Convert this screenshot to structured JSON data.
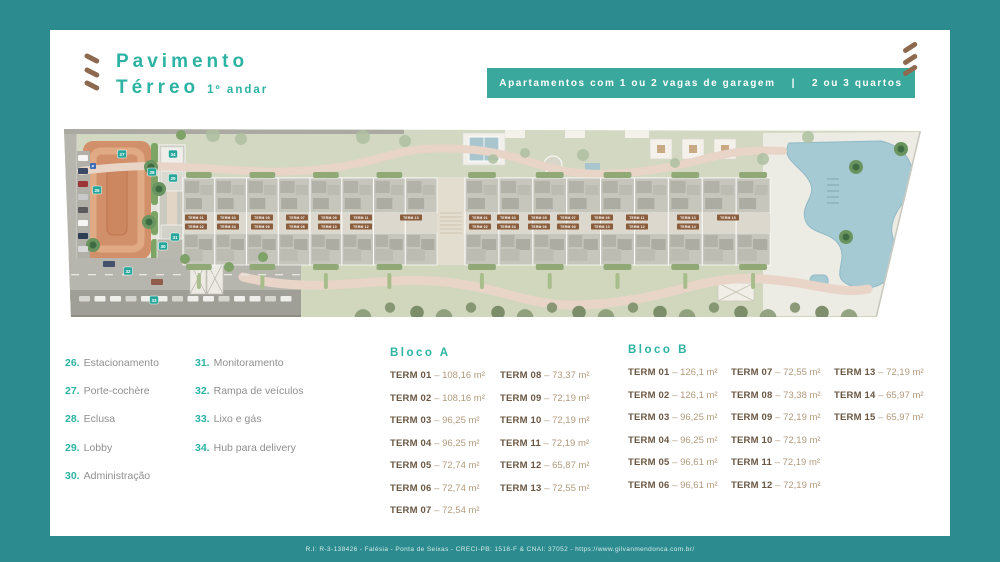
{
  "header": {
    "title_line1": "Pavimento",
    "title_line2": "Térreo",
    "title_suffix": "1º andar",
    "banner_left": "Apartamentos com 1 ou 2 vagas de garagem",
    "banner_divider": "|",
    "banner_right": "2 ou 3 quartos"
  },
  "legend": {
    "column1": [
      {
        "num": "26.",
        "label": "Estacionamento"
      },
      {
        "num": "27.",
        "label": "Porte-cochère"
      },
      {
        "num": "28.",
        "label": "Eclusa"
      },
      {
        "num": "29.",
        "label": "Lobby"
      },
      {
        "num": "30.",
        "label": "Administração"
      }
    ],
    "column2": [
      {
        "num": "31.",
        "label": "Monitoramento"
      },
      {
        "num": "32.",
        "label": "Rampa de veículos"
      },
      {
        "num": "33.",
        "label": "Lixo e gás"
      },
      {
        "num": "34.",
        "label": "Hub para delivery"
      }
    ]
  },
  "separator": "–",
  "bloco_a": {
    "title": "Bloco A",
    "columns": [
      [
        {
          "term": "TERM 01",
          "area": "108,16 m²"
        },
        {
          "term": "TERM 02",
          "area": "108,16 m²"
        },
        {
          "term": "TERM 03",
          "area": "96,25 m²"
        },
        {
          "term": "TERM 04",
          "area": "96,25 m²"
        },
        {
          "term": "TERM 05",
          "area": "72,74 m²"
        },
        {
          "term": "TERM 06",
          "area": "72,74 m²"
        },
        {
          "term": "TERM 07",
          "area": "72,54 m²"
        }
      ],
      [
        {
          "term": "TERM 08",
          "area": "73,37 m²"
        },
        {
          "term": "TERM 09",
          "area": "72,19 m²"
        },
        {
          "term": "TERM 10",
          "area": "72,19 m²"
        },
        {
          "term": "TERM 11",
          "area": "72,19 m²"
        },
        {
          "term": "TERM 12",
          "area": "65,87 m²"
        },
        {
          "term": "TERM 13",
          "area": "72,55 m²"
        }
      ]
    ]
  },
  "bloco_b": {
    "title": "Bloco B",
    "columns": [
      [
        {
          "term": "TERM 01",
          "area": "126,1 m²"
        },
        {
          "term": "TERM 02",
          "area": "126,1 m²"
        },
        {
          "term": "TERM 03",
          "area": "96,25 m²"
        },
        {
          "term": "TERM 04",
          "area": "96,25 m²"
        },
        {
          "term": "TERM 05",
          "area": "96,61 m²"
        },
        {
          "term": "TERM 06",
          "area": "96,61 m²"
        }
      ],
      [
        {
          "term": "TERM 07",
          "area": "72,55 m²"
        },
        {
          "term": "TERM 08",
          "area": "73,38 m²"
        },
        {
          "term": "TERM 09",
          "area": "72,19 m²"
        },
        {
          "term": "TERM 10",
          "area": "72,19 m²"
        },
        {
          "term": "TERM 11",
          "area": "72,19 m²"
        },
        {
          "term": "TERM 12",
          "area": "72,19 m²"
        }
      ],
      [
        {
          "term": "TERM 13",
          "area": "72,19 m²"
        },
        {
          "term": "TERM 14",
          "area": "65,97 m²"
        },
        {
          "term": "TERM 15",
          "area": "65,97 m²"
        }
      ]
    ]
  },
  "plan": {
    "badges": [
      {
        "num": "27",
        "x": 59,
        "y": 27
      },
      {
        "num": "34",
        "x": 110,
        "y": 27
      },
      {
        "num": "28",
        "x": 89,
        "y": 45
      },
      {
        "num": "29",
        "x": 110,
        "y": 51
      },
      {
        "num": "26",
        "x": 34,
        "y": 63
      },
      {
        "num": "31",
        "x": 112,
        "y": 110
      },
      {
        "num": "30",
        "x": 100,
        "y": 119
      },
      {
        "num": "32",
        "x": 65,
        "y": 144
      },
      {
        "num": "33",
        "x": 91,
        "y": 173
      }
    ],
    "parking_symbol": "P",
    "unit_labels_a": [
      "TERM 01",
      "TERM 02",
      "TERM 03",
      "TERM 04",
      "TERM 05",
      "TERM 06",
      "TERM 07",
      "TERM 08",
      "TERM 09",
      "TERM 10",
      "TERM 11",
      "TERM 12",
      "TERM 13"
    ],
    "unit_labels_b": [
      "TERM 01",
      "TERM 02",
      "TERM 03",
      "TERM 04",
      "TERM 05",
      "TERM 06",
      "TERM 07",
      "TERM 08",
      "TERM 09",
      "TERM 10",
      "TERM 11",
      "TERM 12",
      "TERM 13",
      "TERM 14",
      "TERM 15"
    ]
  },
  "footer": {
    "text": "R.I: R-3-138426 - Falésia - Ponta de Seixas - CRECI-PB: 1518-F & CNAI: 37052 - https://www.gilvanmendonca.com.br/"
  },
  "colors": {
    "frame": "#2b8b8f",
    "accent": "#2cb3a3",
    "banner": "#3aa89c",
    "brown": "#8d6a4f",
    "term_dark": "#6a5743",
    "term_value": "#b19a7c",
    "legend_text": "#8f8f8f",
    "badge": "#26a69a",
    "court_orange": "#d1906a",
    "pool_blue": "#a5cad4",
    "lawn_green": "#cfd6ba",
    "path_pink": "#e9d4c8"
  }
}
